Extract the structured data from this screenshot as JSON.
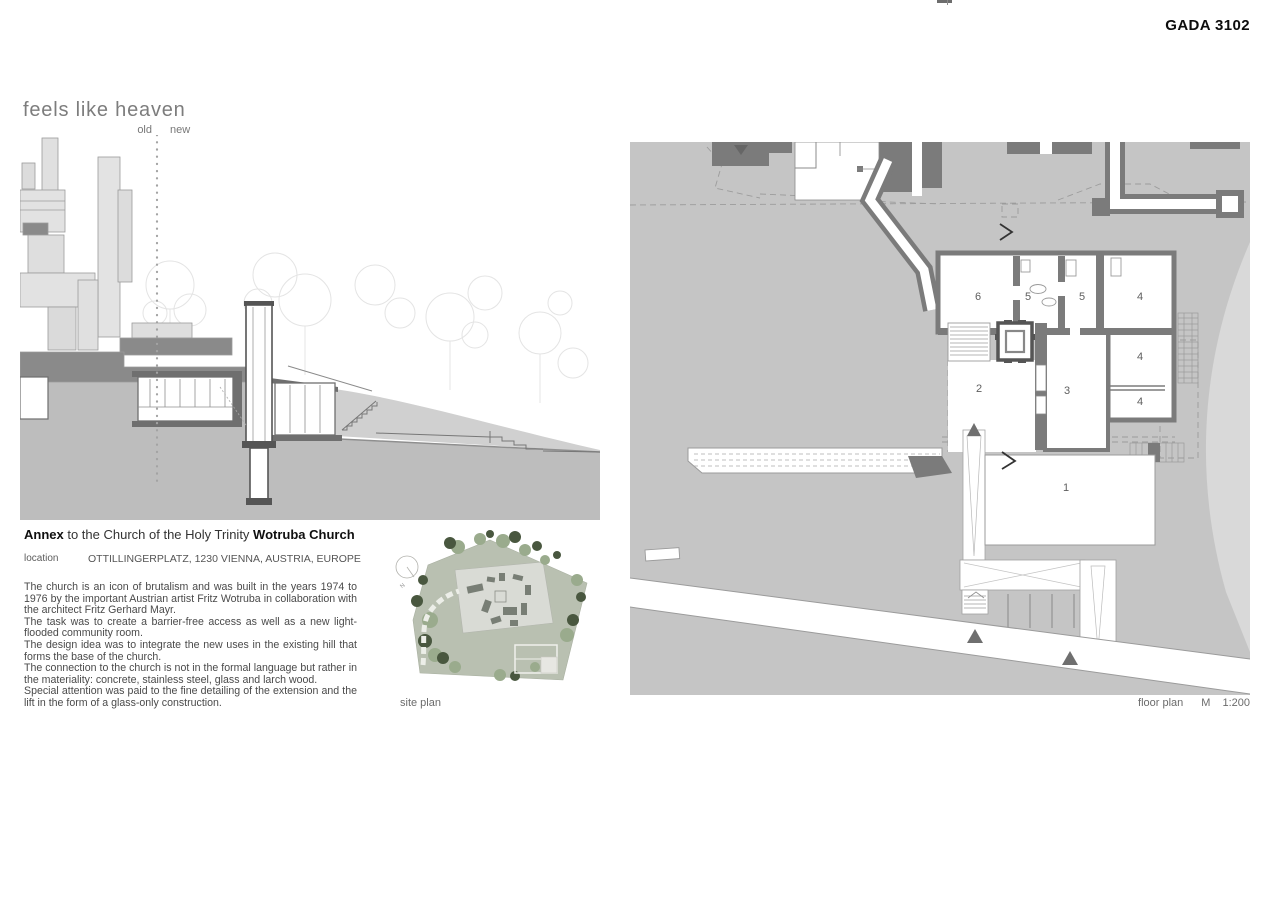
{
  "page": {
    "code": "GADA 3102",
    "title": "feels like heaven"
  },
  "section": {
    "old_label": "old",
    "new_label": "new",
    "caption_bold1": "Annex",
    "caption_mid": " to the Church of the Holy Trinity ",
    "caption_bold2": "Wotruba Church"
  },
  "location": {
    "label": "location",
    "value": "OTTILLINGERPLATZ, 1230 VIENNA, AUSTRIA, EUROPE"
  },
  "description": {
    "lines": [
      "The church is an icon of brutalism and was built in the years 1974 to 1976 by the important Austrian artist Fritz Wotruba in collaboration with the architect Fritz Gerhard Mayr.",
      "The task was to create a barrier-free access as well as a new light-flooded community room.",
      "The design idea was to integrate the new uses in the existing hill that forms the base of the church.",
      "The connection to the church is not in the formal language but rather in the materiality: concrete, stainless steel, glass and larch wood.",
      "Special attention was paid to the fine detailing of the extension and the lift in the form of a glass-only construction."
    ]
  },
  "site_plan": {
    "caption": "site plan",
    "north_label": "N"
  },
  "floor_plan": {
    "caption": "floor plan",
    "scale_label": "M",
    "scale_value": "1:200",
    "rooms": [
      "6",
      "5",
      "5",
      "4",
      "4",
      "2",
      "3",
      "4",
      "1"
    ]
  },
  "colors": {
    "wall_dark": "#7b7b7b",
    "hill_gray": "#c5c5c5",
    "hill_light": "#d9d9d9",
    "earth_gray": "#bdbdbd",
    "church_block_light": "#dfdfdf",
    "church_block_dark": "#8a8a8a",
    "site_green": "#b9c0b1",
    "tree_dark": "#49573f",
    "tree_light": "#9aab8d",
    "text_gray": "#6b6b6b"
  }
}
